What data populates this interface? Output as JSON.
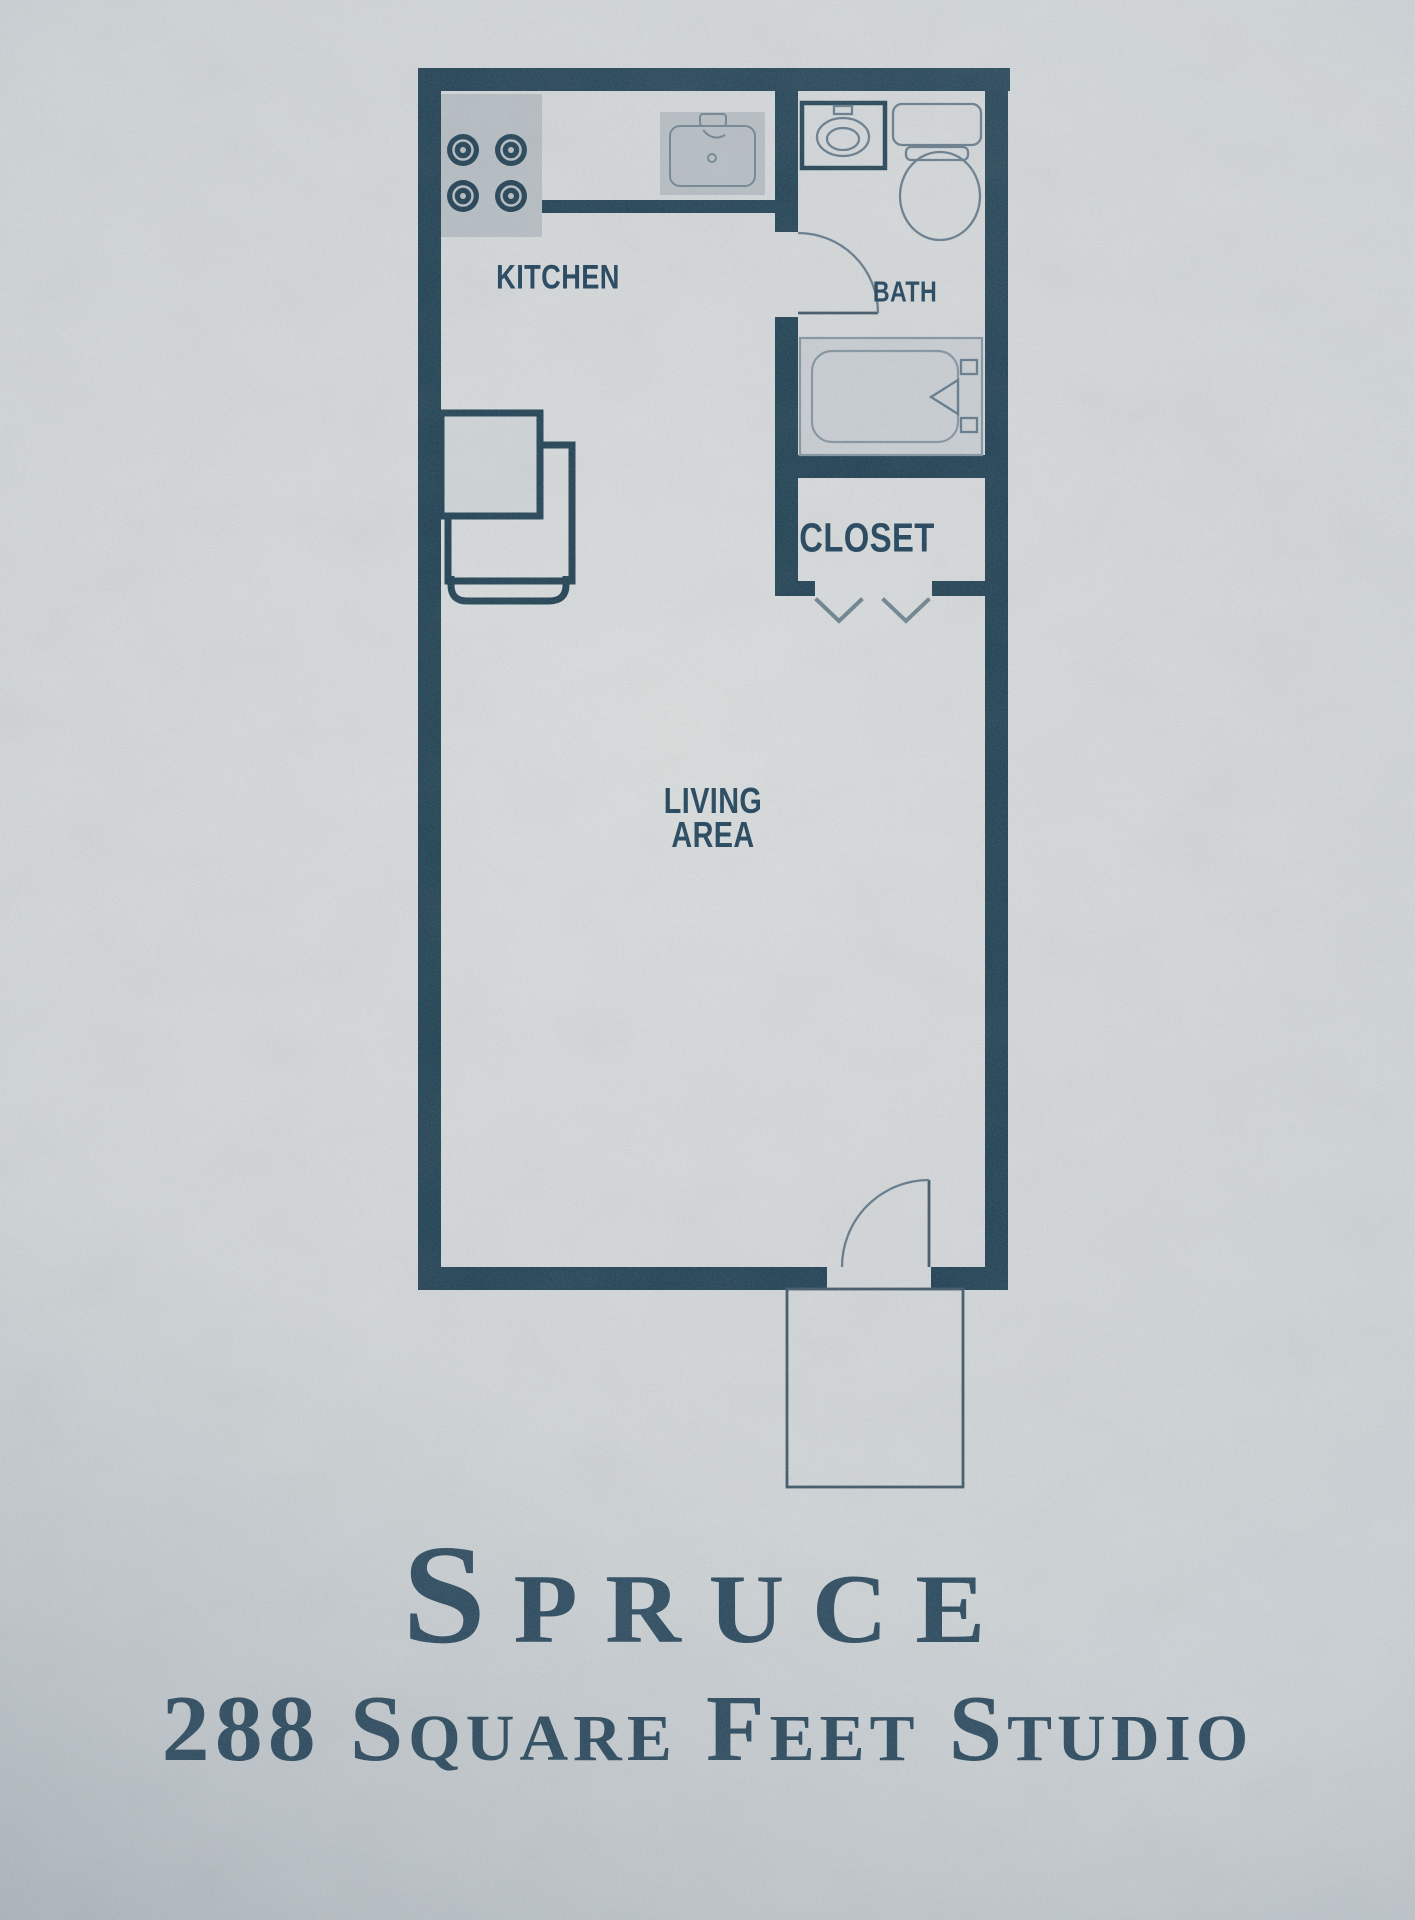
{
  "floor_plan": {
    "rooms": [
      {
        "name": "kitchen",
        "label": "KITCHEN"
      },
      {
        "name": "bath",
        "label": "BATH"
      },
      {
        "name": "closet",
        "label": "CLOSET"
      },
      {
        "name": "living-area",
        "label_line1": "LIVING",
        "label_line2": "AREA"
      }
    ],
    "fixtures": [
      "stove-icon",
      "kitchen-sink-icon",
      "refrigerator-icon",
      "bathroom-sink-icon",
      "toilet-icon",
      "bathtub-icon",
      "bath-door-icon",
      "closet-bifold-doors-icon",
      "entry-door-icon",
      "entry-stoop-icon"
    ]
  },
  "footer": {
    "title": "Spruce",
    "subtitle": "288 Square Feet Studio"
  },
  "colors": {
    "paper": "#cfd4d7",
    "paper-light": "#dadddd",
    "paper-dark": "#b6bec5",
    "wall": "#1f4053",
    "label": "#1e415a",
    "title": "#2a495e",
    "pencil": "#63798a",
    "pencil-dark": "#3e5766",
    "fixture-fill": "#b5bdc3",
    "fixture-line": "#6e8290",
    "tub-fill": "#c9ced3"
  }
}
